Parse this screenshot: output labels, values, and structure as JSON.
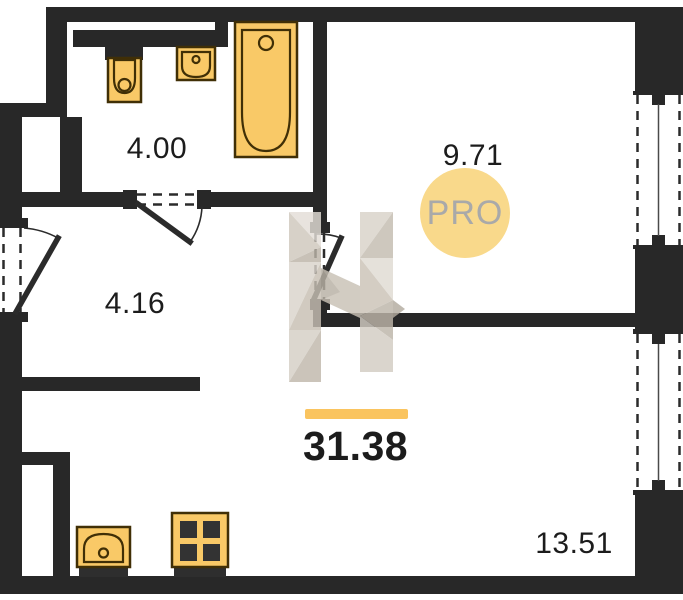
{
  "plan": {
    "type": "floor-plan",
    "total_area": "31.38",
    "badge": "PRO",
    "rooms": [
      {
        "name": "bathroom",
        "area": "4.00"
      },
      {
        "name": "room-top-right",
        "area": "9.71"
      },
      {
        "name": "hallway",
        "area": "4.16"
      },
      {
        "name": "room-bottom-right",
        "area": "13.51"
      }
    ],
    "fixtures": [
      "toilet",
      "bathroom-sink",
      "bathtub",
      "kitchen-sink",
      "stove"
    ],
    "doors": [
      "entrance-door",
      "bathroom-door",
      "room-top-right-door"
    ],
    "windows": [
      "room-top-right-window",
      "room-bottom-right-window"
    ],
    "colors": {
      "wall": "#282828",
      "fixture_fill": "#F9C967",
      "fixture_stroke": "#402F06",
      "accent_bar": "#FAC45F",
      "badge_fill": "#F9D98B",
      "badge_text_color": "#A9A9A9",
      "label_color": "#1C1C1C",
      "watermark_light": "#E0DBD3",
      "watermark_mid": "#CFC8BD",
      "watermark_dark": "#BCB4A8"
    }
  }
}
